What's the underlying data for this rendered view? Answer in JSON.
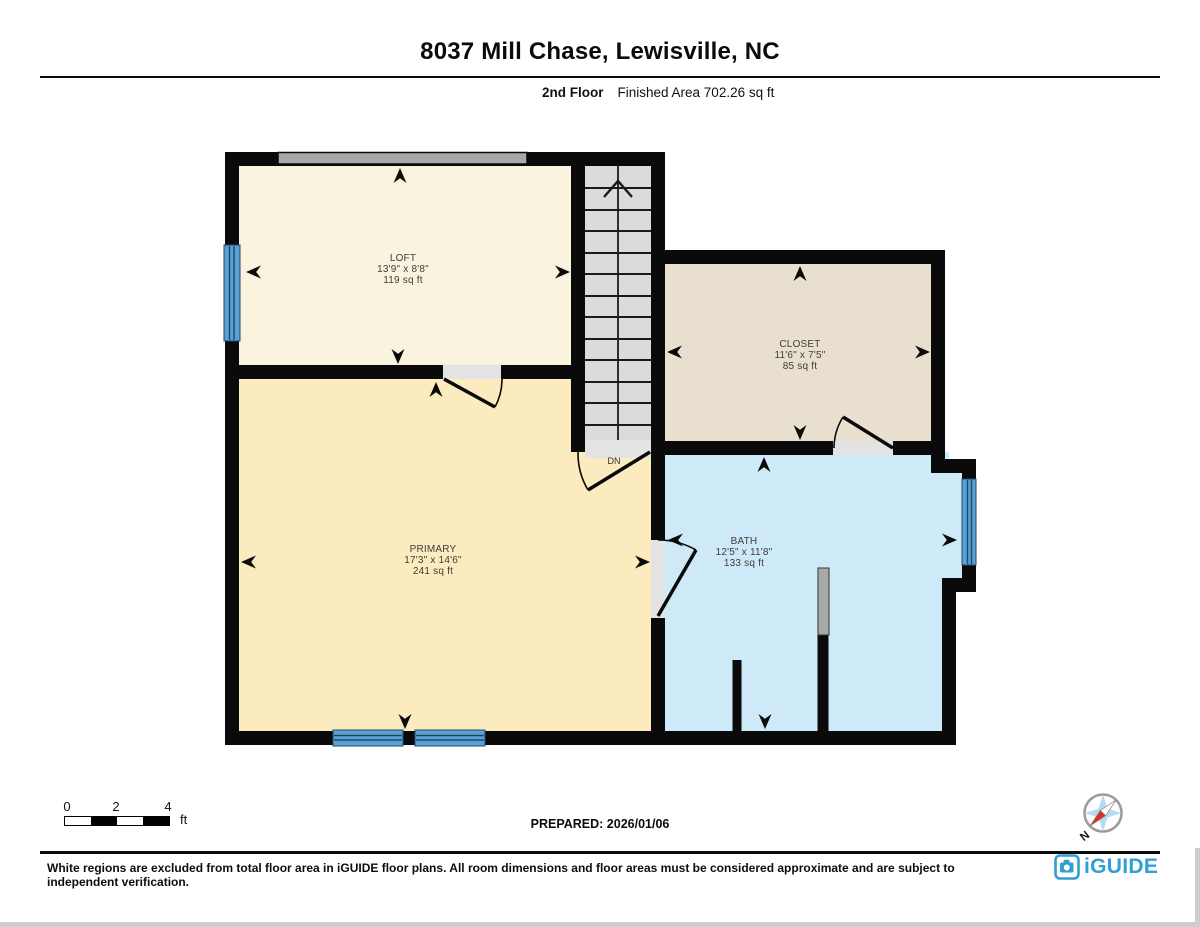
{
  "header": {
    "title": "8037 Mill Chase, Lewisville, NC",
    "floor_label": "2nd Floor",
    "area_label": "Finished Area 702.26 sq ft"
  },
  "plan": {
    "rooms": [
      {
        "name": "LOFT",
        "dims": "13'9\" x 8'8\"",
        "area": "119 sq ft"
      },
      {
        "name": "CLOSET",
        "dims": "11'6\" x 7'5\"",
        "area": "85 sq ft"
      },
      {
        "name": "PRIMARY",
        "dims": "17'3\" x 14'6\"",
        "area": "241 sq ft"
      },
      {
        "name": "BATH",
        "dims": "12'5\" x 11'8\"",
        "area": "133 sq ft"
      }
    ],
    "stairs_label": "DN"
  },
  "scale_bar": {
    "ticks": [
      "0",
      "2",
      "4"
    ],
    "unit": "ft"
  },
  "prepared_label": "PREPARED: 2026/01/06",
  "compass": {
    "north_label": "N"
  },
  "footer": {
    "disclaimer": "White regions are excluded from total floor area in iGUIDE floor plans. All room dimensions and floor areas must be considered approximate and are subject to independent verification.",
    "brand": "iGUIDE"
  },
  "colors": {
    "loft_fill": "#FAF3DE",
    "primary_fill": "#FCEBBE",
    "closet_fill": "#E9DFCE",
    "bath_fill": "#CEE9F8",
    "stairs_fill": "#DBDBDB",
    "opening_fill": "#E3E3E3",
    "window_blue": "#5AA2D4",
    "knee_wall_gray": "#A8A8A8",
    "wall_black": "#0A0A0A",
    "brand_blue": "#2F9FD4"
  }
}
